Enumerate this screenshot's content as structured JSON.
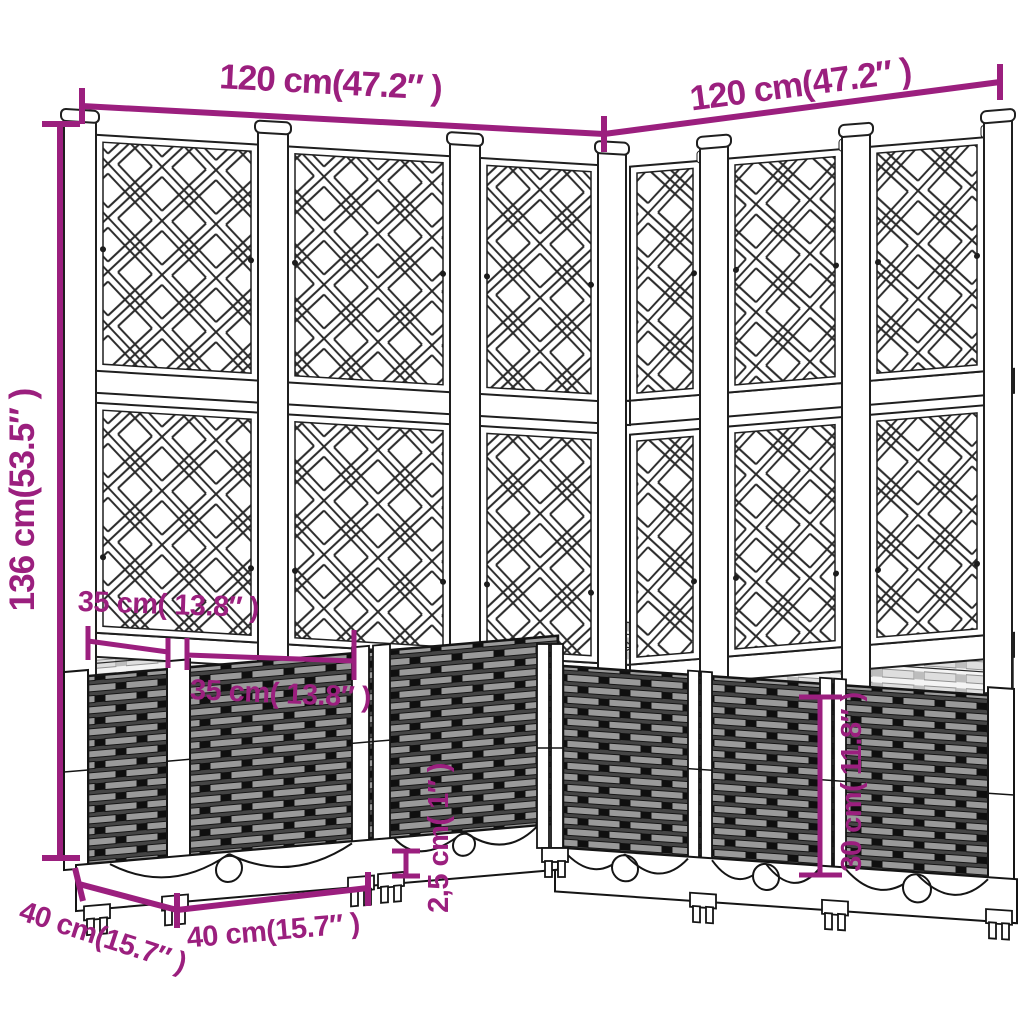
{
  "colors": {
    "annotation": "#9B1F7E",
    "line_art": "#1f1f1f",
    "rattan_dark": "#454545",
    "rattan_slat": "#9a9a9a",
    "background": "#ffffff"
  },
  "annotations": {
    "top_width_left": "120 cm(47.2″ )",
    "top_width_right": "120 cm(47.2″ )",
    "total_height": "136 cm(53.5″ )",
    "planter_depth_top": "35 cm( 13.8″ )",
    "planter_module_width_top": "35 cm( 13.8″ )",
    "base_depth": "40 cm(15.7″ )",
    "base_module_width": "40 cm(15.7″ )",
    "foot_height": "2,5 cm( 1″ )",
    "planter_box_height": "30 cm( 11.8″ )"
  }
}
